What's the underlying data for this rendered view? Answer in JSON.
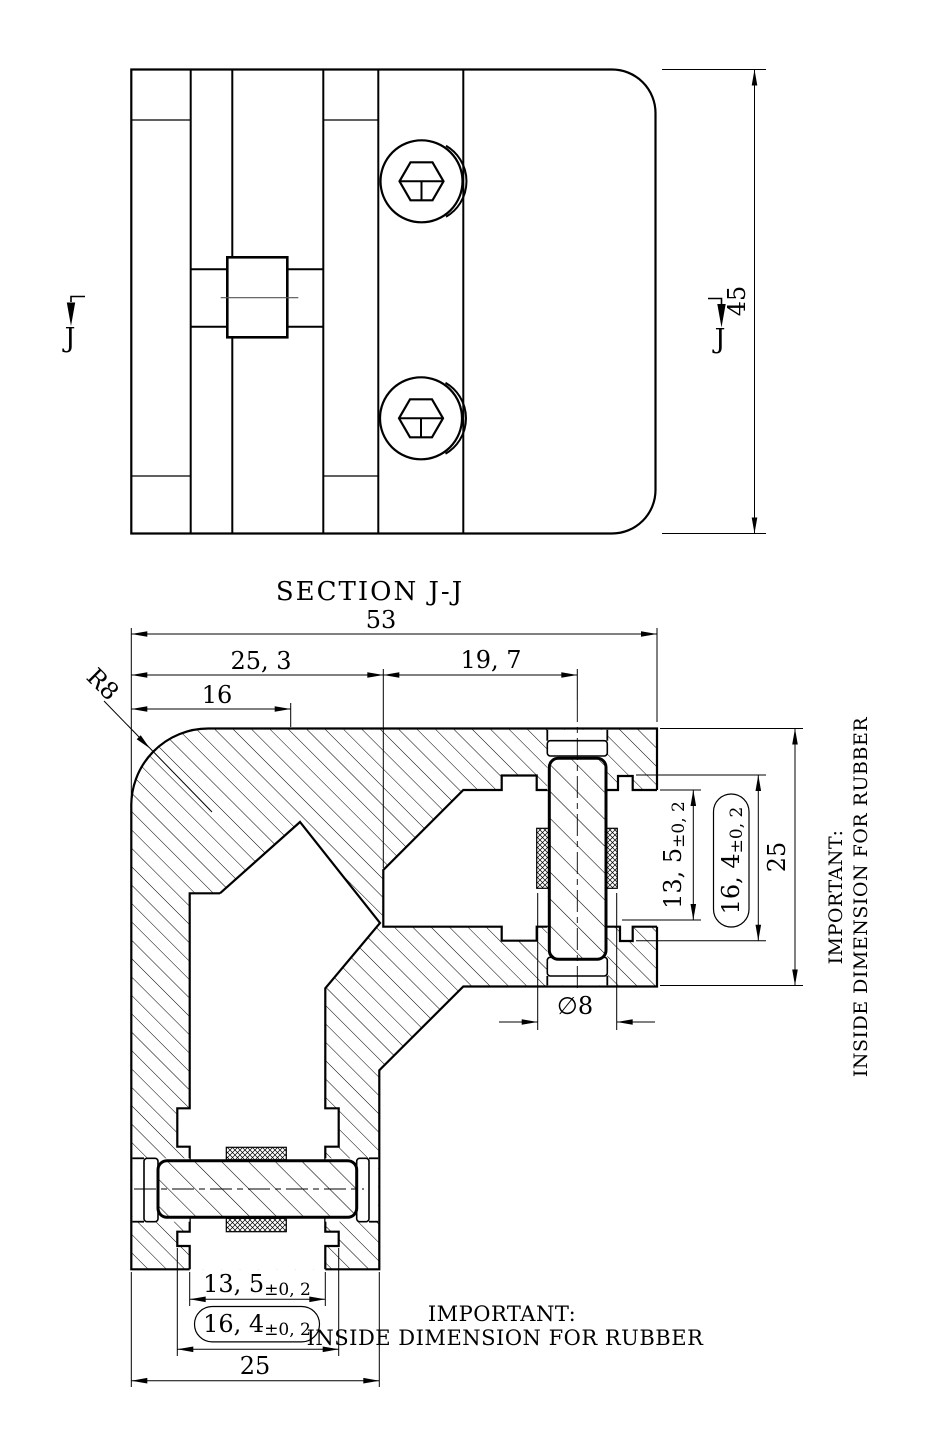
{
  "drawing": {
    "top_view": {
      "height_dim": "45",
      "marker_left": "J",
      "marker_right": "J"
    },
    "section": {
      "title": "SECTION J-J",
      "dim_total_width": "53",
      "dim_left_width": "25, 3",
      "dim_right_width": "19, 7",
      "dim_edge": "16",
      "dim_radius": "R8",
      "bolt_dia": "∅8",
      "right_dims": {
        "gap": {
          "value": "13, 5",
          "tol": "±0, 2"
        },
        "rubber": {
          "value": "16, 4",
          "tol": "±0, 2"
        },
        "outer": "25"
      },
      "bottom_dims": {
        "gap": {
          "value": "13, 5",
          "tol": "±0, 2"
        },
        "rubber": {
          "value": "16, 4",
          "tol": "±0, 2"
        },
        "outer": "25"
      },
      "note_right": {
        "line1": "IMPORTANT:",
        "line2": "INSIDE DIMENSION FOR RUBBER"
      },
      "note_bottom": {
        "line1": "IMPORTANT:",
        "line2": "INSIDE DIMENSION FOR RUBBER"
      }
    }
  }
}
